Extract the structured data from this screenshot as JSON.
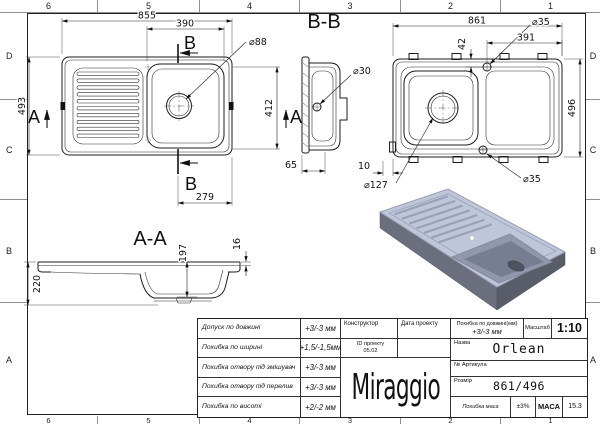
{
  "sheet": {
    "cols": [
      "6",
      "5",
      "4",
      "3",
      "2",
      "1"
    ],
    "rows": [
      "D",
      "C",
      "B",
      "A"
    ]
  },
  "top_view": {
    "dim_width": "855",
    "dim_bowl_width": "390",
    "dim_height": "493",
    "dim_bowl_height": "412",
    "dim_bowl_offset": "279",
    "dim_drain": "⌀88",
    "label_section_b_top": "B",
    "label_section_b_bottom": "B",
    "label_section_a_left": "A",
    "label_section_a_right": "A"
  },
  "section_bb": {
    "title": "B-B",
    "dim_hole": "⌀30",
    "dim_edge": "65"
  },
  "bottom_view": {
    "dim_width": "861",
    "dim_tap_top": "⌀35",
    "dim_tap_offset_y": "42",
    "dim_tap_offset_x": "391",
    "dim_height": "496",
    "dim_clip_offset": "10",
    "dim_drain": "⌀127",
    "dim_tap_bottom": "⌀35"
  },
  "section_aa": {
    "title": "A-A",
    "dim_height": "220",
    "dim_bowl_depth": "197",
    "dim_rim": "16"
  },
  "render_colors": {
    "top_face": "#c0c6d9",
    "side_left": "#6b6f7d",
    "side_right": "#595d69",
    "bowl": "#9298ab",
    "bowl_shade": "#787e91",
    "drain": "#4f5360"
  },
  "title_block": {
    "tolerances": [
      {
        "label": "Допуск по довжині",
        "value": "+3/-3 мм"
      },
      {
        "label": "Похибка по ширині",
        "value": "+1,5/-1,5мм"
      },
      {
        "label": "Похибка отвору під змішувач",
        "value": "+3/-3 мм"
      },
      {
        "label": "Похибка отвору під перелив",
        "value": "+3/-3 мм"
      },
      {
        "label": "Похибка по висоті",
        "value": "+2/-2 мм"
      }
    ],
    "constructor_label": "Конструктор",
    "date_label": "Дата проекту",
    "project_id_label": "ID проекту",
    "project_id_value": "05.02",
    "logo": "Miraggio",
    "length_tol_label": "Похибка по довжині(мм)",
    "length_tol_value": "+3/-3 мм",
    "scale_label": "Масштаб",
    "scale_value": "1:10",
    "name_label": "Назва",
    "name_value": "Orlean",
    "article_label": "№ Артикула",
    "size_label": "Розмір",
    "size_value": "861/496",
    "mass_tol_label": "Похибка маса",
    "mass_tol_value": "±3%",
    "mass_label": "МАСА",
    "mass_value": "15.3"
  }
}
